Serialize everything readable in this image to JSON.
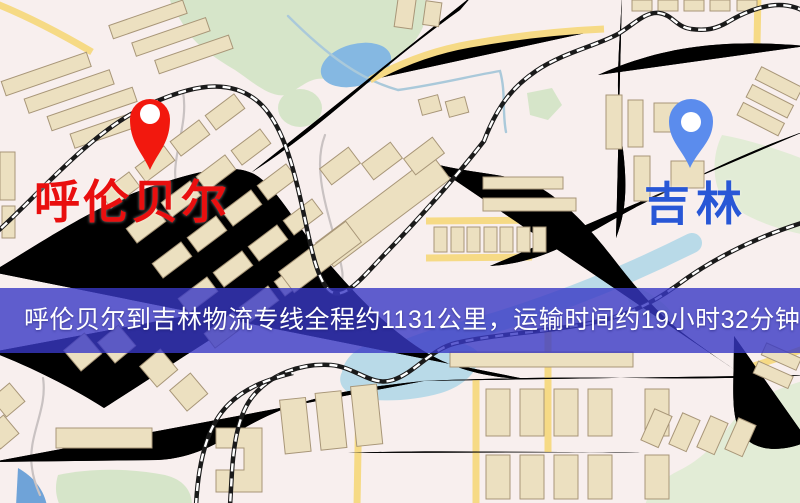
{
  "origin_marker": {
    "label": "呼伦贝尔",
    "pin_color": "#f2180e",
    "label_color": "#e90f0f"
  },
  "destination_marker": {
    "label": "吉林",
    "pin_color": "#5b8ced",
    "label_color": "#2857d6"
  },
  "banner": {
    "text": "呼伦贝尔到吉林物流专线全程约1131公里，运输时间约19小时32分钟.",
    "background": "rgba(56,56,196,0.8)",
    "text_color": "#ffffff"
  },
  "map_palette": {
    "background": "#f8efee",
    "road_fill": "#f4d169",
    "road_casing": "#ddab52",
    "park": "#d6e5c9",
    "lake": "#85b8e2",
    "river": "#b9dae8",
    "railway": "#1a1a1a",
    "building": "#ece0c0"
  }
}
